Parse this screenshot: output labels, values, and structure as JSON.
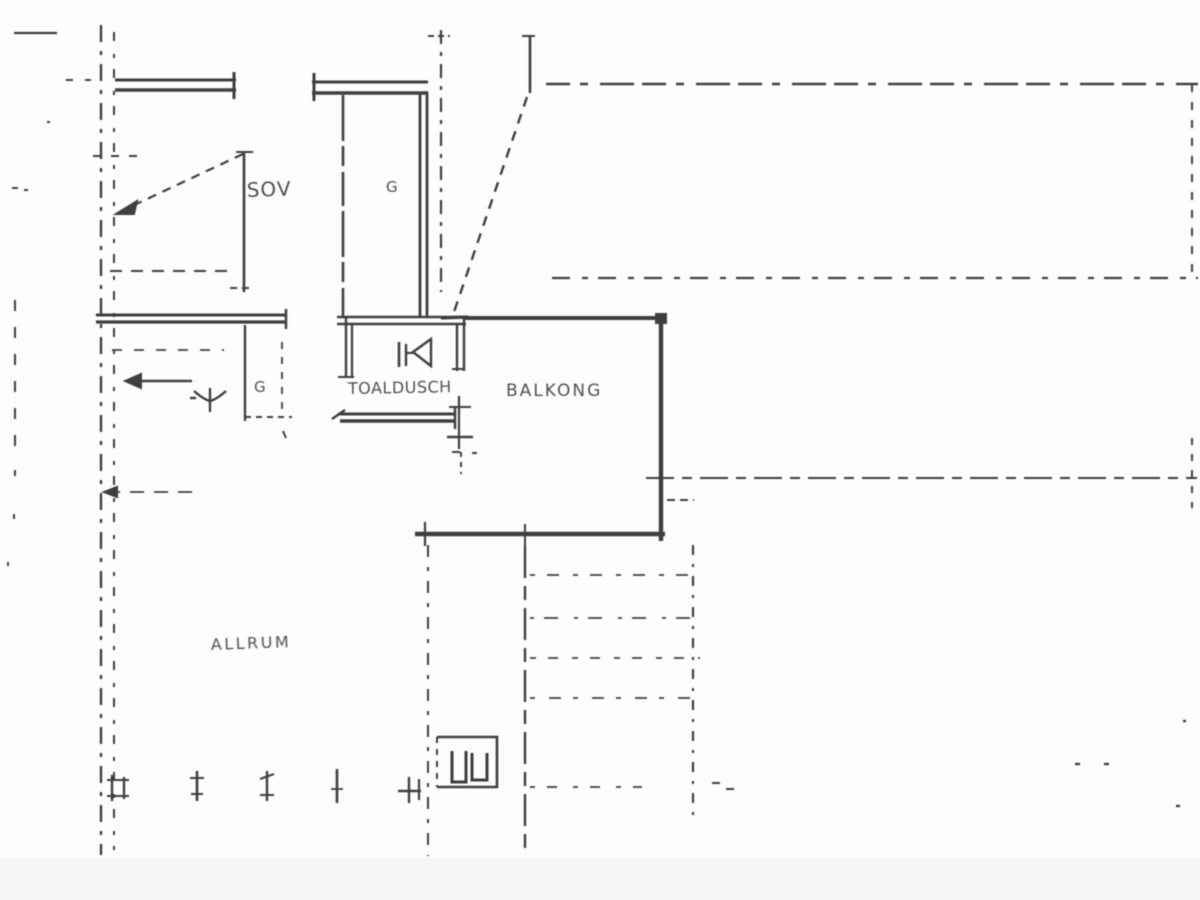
{
  "page": {
    "paper_color": "#fdfdfc",
    "ink_color": "#2b2b2b"
  },
  "floorplan": {
    "labels": {
      "bedroom": "SOV",
      "wardrobe_top": "G",
      "wardrobe_hall": "G",
      "bathroom": "TOALDUSCH",
      "balcony": "BALKONG",
      "living_room": "ALLRUM"
    }
  }
}
